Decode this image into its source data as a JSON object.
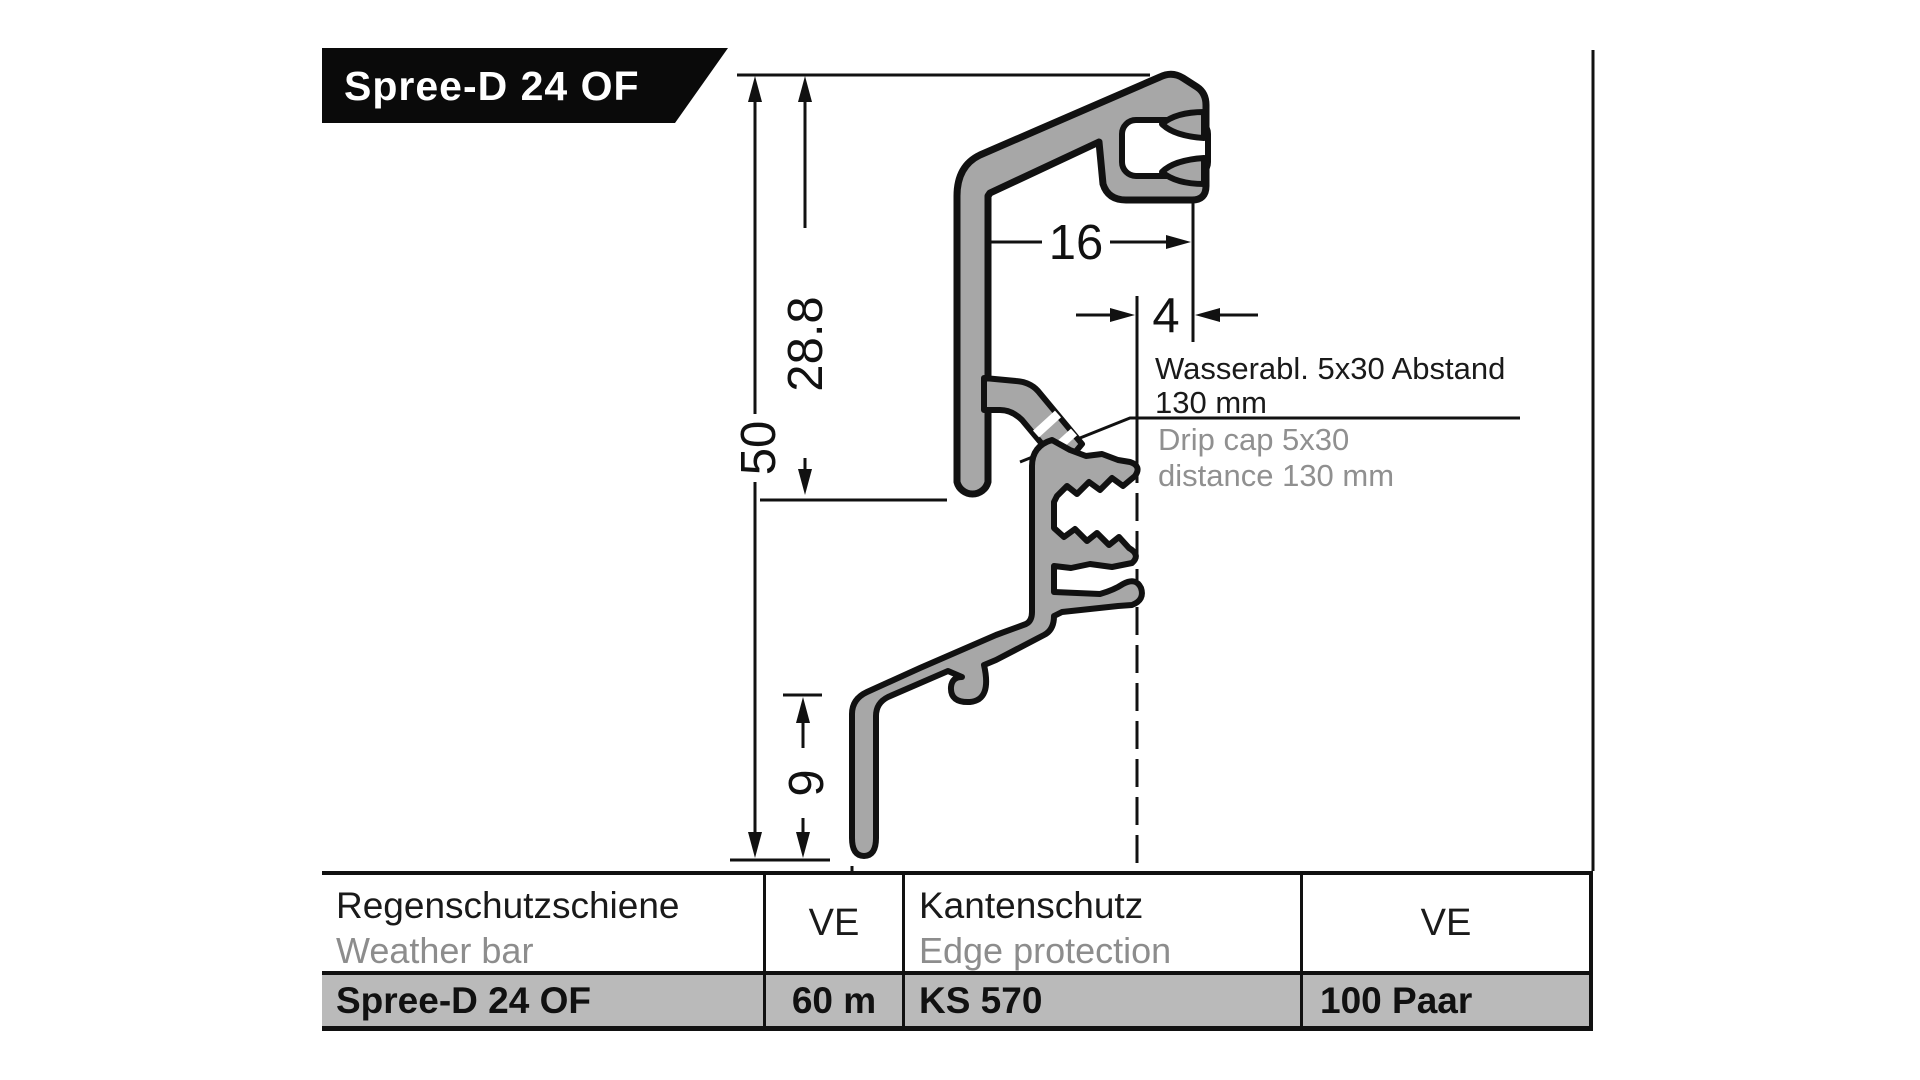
{
  "banner": {
    "title": "Spree-D 24 OF"
  },
  "drawing": {
    "dims": {
      "height_total": "50",
      "height_upper": "28.8",
      "width_top": "16",
      "offset_right": "4",
      "height_leg": "9",
      "width_bottom": "20"
    },
    "note_de_1": "Wasserabl. 5x30 Abstand",
    "note_de_2": "130 mm",
    "note_en_1": "Drip cap 5x30",
    "note_en_2": "distance 130 mm"
  },
  "table": {
    "col1_header_de": "Regenschutzschiene",
    "col1_header_en": "Weather bar",
    "col2_header": "VE",
    "col3_header_de": "Kantenschutz",
    "col3_header_en": "Edge protection",
    "col4_header": "VE",
    "row": {
      "product": "Spree-D 24 OF",
      "ve1": "60 m",
      "edge_product": "KS 570",
      "ve2": "100 Paar"
    }
  },
  "colors": {
    "profile_fill": "#a7a7a7",
    "outline": "#111111",
    "secondary_text": "#8d8d8d",
    "row_highlight": "#bababa",
    "banner_bg": "#0a0a0a",
    "banner_text": "#ffffff"
  }
}
